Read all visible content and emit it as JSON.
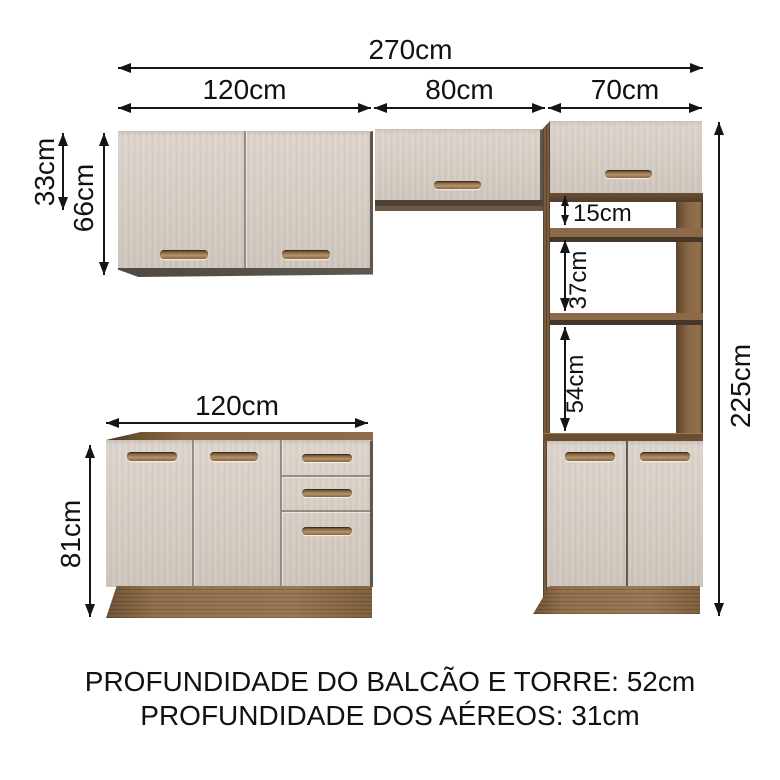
{
  "dims": {
    "total_width": "270cm",
    "upper_left_width": "120cm",
    "upper_middle_width": "80cm",
    "tower_width": "70cm",
    "upper_middle_height": "33cm",
    "upper_left_height": "66cm",
    "tower_height": "225cm",
    "tower_top_gap": "15cm",
    "tower_middle_gap": "37cm",
    "tower_bottom_gap": "54cm",
    "base_width": "120cm",
    "base_height": "81cm"
  },
  "footer": {
    "balcao_tower_depth": "PROFUNDIDADE DO BALCÃO E TORRE: 52cm",
    "aereos_depth": "PROFUNDIDADE DOS AÉREOS: 31cm"
  },
  "colors": {
    "background": "#ffffff",
    "door_cream": "#d6cdc4",
    "wood_mid": "#6f5235",
    "wood_light": "#8d6c47",
    "wood_dark": "#46362a",
    "dimension_line": "#151515"
  }
}
